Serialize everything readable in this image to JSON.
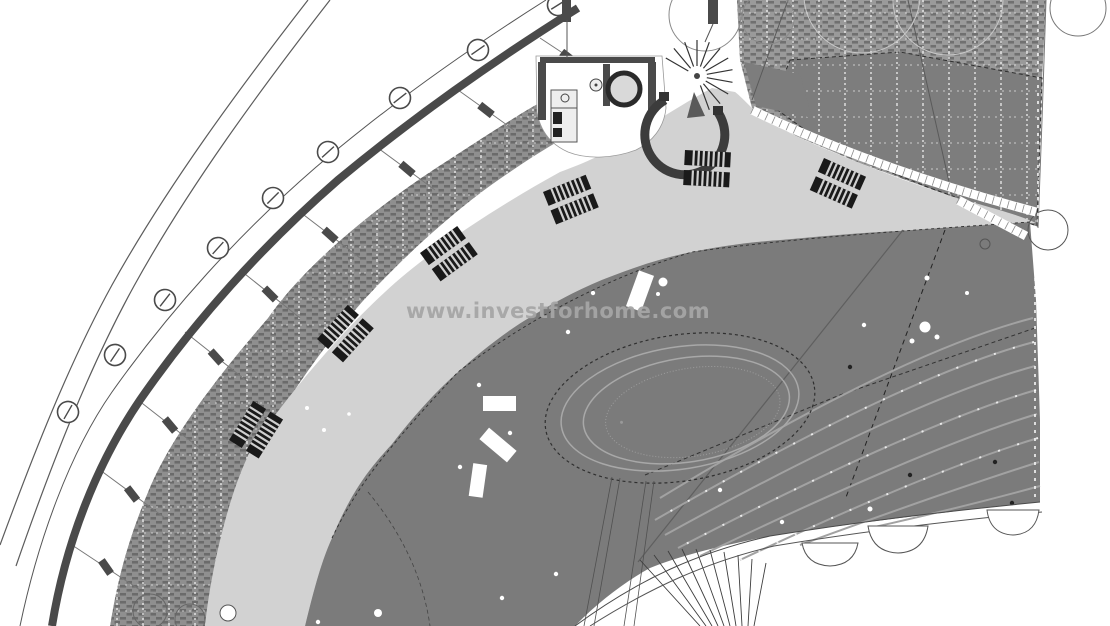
{
  "watermark": {
    "text": "www.investforhome.com"
  },
  "palette": {
    "background": "#ffffff",
    "deck": "#d2d2d2",
    "terrace": "#7b7b7b",
    "hatch_base": "#8f8f8f",
    "hatch_base_tr": "#9a9a9a",
    "hatch_dark_zone": "#7d7d7d",
    "wall": "#4a4a4a",
    "line_dark": "#333333",
    "black": "#1a1a1a",
    "contour": "#a2a2a2",
    "watermark": "#a6a6a6"
  },
  "plan": {
    "type": "architectural-site-plan",
    "features": {
      "lounger_pairs": 6,
      "spiral_staircase": 1,
      "pool_ellipses": 4,
      "column_markers": 9,
      "tree_outlines": 9,
      "planter_rects": 4
    }
  }
}
